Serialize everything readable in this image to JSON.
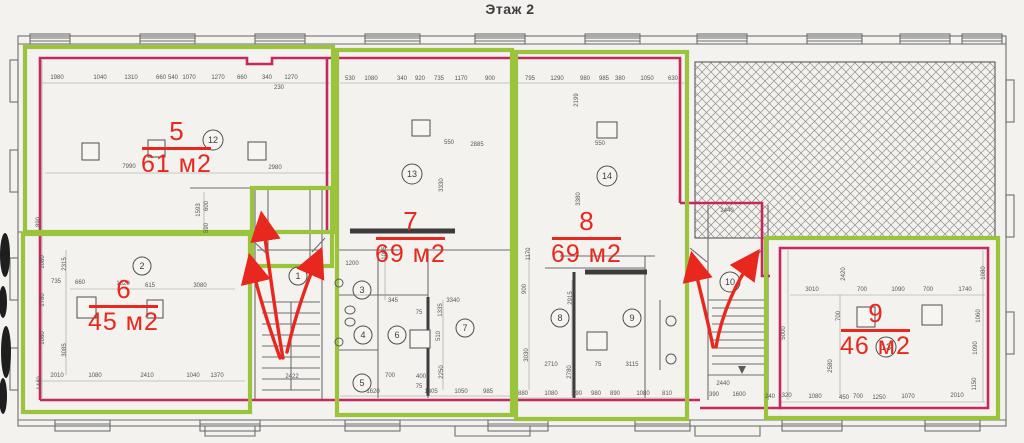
{
  "title": "Этаж 2",
  "colors": {
    "paper": "#f3f2ee",
    "line_gray": "#6e6e6e",
    "dim_text": "#565656",
    "annotation_red": "#e8281e",
    "boundary_magenta": "#c5285a",
    "highlight_green": "#9ac43c",
    "dark_wall": "#3c3c3c"
  },
  "apartments": [
    {
      "number": "5",
      "area": "61 м2"
    },
    {
      "number": "6",
      "area": "45 м2"
    },
    {
      "number": "7",
      "area": "69 м2"
    },
    {
      "number": "8",
      "area": "69 м2"
    },
    {
      "number": "9",
      "area": "46 м2"
    }
  ],
  "room_circles": [
    {
      "n": "1",
      "x": 298,
      "y": 276
    },
    {
      "n": "2",
      "x": 142,
      "y": 266
    },
    {
      "n": "3",
      "x": 362,
      "y": 290
    },
    {
      "n": "4",
      "x": 363,
      "y": 335
    },
    {
      "n": "5",
      "x": 362,
      "y": 383
    },
    {
      "n": "6",
      "x": 397,
      "y": 335
    },
    {
      "n": "7",
      "x": 465,
      "y": 328
    },
    {
      "n": "8",
      "x": 560,
      "y": 318
    },
    {
      "n": "9",
      "x": 632,
      "y": 318
    },
    {
      "n": "10",
      "x": 730,
      "y": 282
    },
    {
      "n": "12",
      "x": 213,
      "y": 140
    },
    {
      "n": "13",
      "x": 412,
      "y": 174
    },
    {
      "n": "14",
      "x": 607,
      "y": 176
    },
    {
      "n": "13",
      "x": 886,
      "y": 347
    }
  ],
  "dimensions": [
    [
      "1980",
      57,
      79
    ],
    [
      "1040",
      100,
      79
    ],
    [
      "1310",
      131,
      79
    ],
    [
      "660",
      161,
      79
    ],
    [
      "540",
      173,
      79
    ],
    [
      "1070",
      189,
      79
    ],
    [
      "1270",
      218,
      79
    ],
    [
      "660",
      242,
      79
    ],
    [
      "340",
      267,
      79
    ],
    [
      "1270",
      291,
      79
    ],
    [
      "230",
      279,
      89
    ],
    [
      "530",
      350,
      80
    ],
    [
      "1080",
      371,
      80
    ],
    [
      "340",
      402,
      80
    ],
    [
      "920",
      420,
      80
    ],
    [
      "735",
      439,
      80
    ],
    [
      "1170",
      461,
      80
    ],
    [
      "900",
      490,
      80
    ],
    [
      "795",
      530,
      80
    ],
    [
      "1290",
      557,
      80
    ],
    [
      "980",
      585,
      80
    ],
    [
      "985",
      604,
      80
    ],
    [
      "380",
      620,
      80
    ],
    [
      "1050",
      647,
      80
    ],
    [
      "630",
      673,
      80
    ],
    [
      "2199",
      578,
      100,
      -90
    ],
    [
      "7990",
      129,
      168
    ],
    [
      "2980",
      275,
      169
    ],
    [
      "890",
      40,
      222,
      -90
    ],
    [
      "1593",
      200,
      210,
      -90
    ],
    [
      "600",
      208,
      206,
      -90
    ],
    [
      "590",
      208,
      228,
      -90
    ],
    [
      "660",
      80,
      284
    ],
    [
      "1820",
      123,
      285
    ],
    [
      "615",
      150,
      287
    ],
    [
      "3080",
      200,
      287
    ],
    [
      "1080",
      44,
      262,
      -90
    ],
    [
      "2315",
      66,
      264,
      -90
    ],
    [
      "735",
      56,
      283
    ],
    [
      "1780",
      44,
      300,
      -90
    ],
    [
      "1080",
      44,
      338,
      -90
    ],
    [
      "3085",
      66,
      350,
      -90
    ],
    [
      "1440",
      41,
      383,
      -90
    ],
    [
      "2010",
      57,
      377
    ],
    [
      "1080",
      95,
      377
    ],
    [
      "2410",
      147,
      377
    ],
    [
      "1040",
      193,
      377
    ],
    [
      "1370",
      217,
      377
    ],
    [
      "2422",
      292,
      378
    ],
    [
      "550",
      449,
      144
    ],
    [
      "2885",
      477,
      146
    ],
    [
      "380",
      430,
      127,
      -90
    ],
    [
      "3330",
      443,
      185,
      -90
    ],
    [
      "1200",
      352,
      265
    ],
    [
      "1095",
      386,
      253,
      -90
    ],
    [
      "345",
      393,
      302
    ],
    [
      "3340",
      453,
      302
    ],
    [
      "75",
      419,
      314
    ],
    [
      "1335",
      442,
      310,
      -90
    ],
    [
      "510",
      440,
      336,
      -90
    ],
    [
      "2250",
      443,
      372,
      -90
    ],
    [
      "700",
      390,
      377
    ],
    [
      "400",
      421,
      378
    ],
    [
      "75",
      419,
      388
    ],
    [
      "1620",
      373,
      393
    ],
    [
      "1305",
      431,
      393
    ],
    [
      "1050",
      461,
      393
    ],
    [
      "985",
      488,
      393
    ],
    [
      "550",
      600,
      145
    ],
    [
      "3380",
      580,
      199,
      -90
    ],
    [
      "1170",
      530,
      254,
      -90
    ],
    [
      "900",
      526,
      289,
      -90
    ],
    [
      "3030",
      528,
      355,
      -90
    ],
    [
      "2915",
      572,
      298,
      -90
    ],
    [
      "2780",
      571,
      372,
      -90
    ],
    [
      "2710",
      551,
      366
    ],
    [
      "75",
      598,
      366
    ],
    [
      "3115",
      632,
      366
    ],
    [
      "880",
      523,
      395
    ],
    [
      "1080",
      551,
      395
    ],
    [
      "790",
      577,
      395
    ],
    [
      "980",
      596,
      395
    ],
    [
      "890",
      615,
      395
    ],
    [
      "1080",
      643,
      395
    ],
    [
      "810",
      667,
      395
    ],
    [
      "2440",
      727,
      212
    ],
    [
      "2440",
      723,
      385
    ],
    [
      "390",
      714,
      396
    ],
    [
      "1600",
      739,
      396
    ],
    [
      "240",
      770,
      398
    ],
    [
      "3010",
      812,
      291
    ],
    [
      "700",
      862,
      291
    ],
    [
      "1090",
      898,
      291
    ],
    [
      "700",
      928,
      291
    ],
    [
      "1740",
      965,
      291
    ],
    [
      "2420",
      845,
      274,
      -90
    ],
    [
      "700",
      840,
      316,
      -90
    ],
    [
      "5000",
      785,
      333,
      -90
    ],
    [
      "2580",
      832,
      366,
      -90
    ],
    [
      "1080",
      985,
      273,
      -90
    ],
    [
      "1060",
      980,
      316,
      -90
    ],
    [
      "1090",
      977,
      348,
      -90
    ],
    [
      "1150",
      976,
      384,
      -90
    ],
    [
      "1320",
      785,
      397
    ],
    [
      "1080",
      815,
      398
    ],
    [
      "450",
      844,
      399
    ],
    [
      "700",
      858,
      398
    ],
    [
      "1250",
      879,
      399
    ],
    [
      "1070",
      908,
      398
    ],
    [
      "2010",
      957,
      397
    ]
  ],
  "columns": [
    [
      82,
      143,
      17,
      17
    ],
    [
      148,
      140,
      17,
      17
    ],
    [
      248,
      142,
      18,
      18
    ],
    [
      412,
      120,
      18,
      16
    ],
    [
      597,
      122,
      20,
      16
    ],
    [
      77,
      297,
      19,
      21
    ],
    [
      147,
      300,
      16,
      18
    ],
    [
      410,
      330,
      20,
      18
    ],
    [
      587,
      332,
      20,
      18
    ],
    [
      857,
      307,
      18,
      20
    ],
    [
      922,
      305,
      20,
      20
    ]
  ],
  "fixtures": {
    "ellipses": [
      [
        350,
        310,
        5,
        4
      ],
      [
        350,
        322,
        5,
        4
      ]
    ],
    "circles": [
      [
        339,
        283,
        4
      ],
      [
        339,
        342,
        4
      ],
      [
        671,
        321,
        5
      ],
      [
        671,
        359,
        5
      ]
    ]
  }
}
